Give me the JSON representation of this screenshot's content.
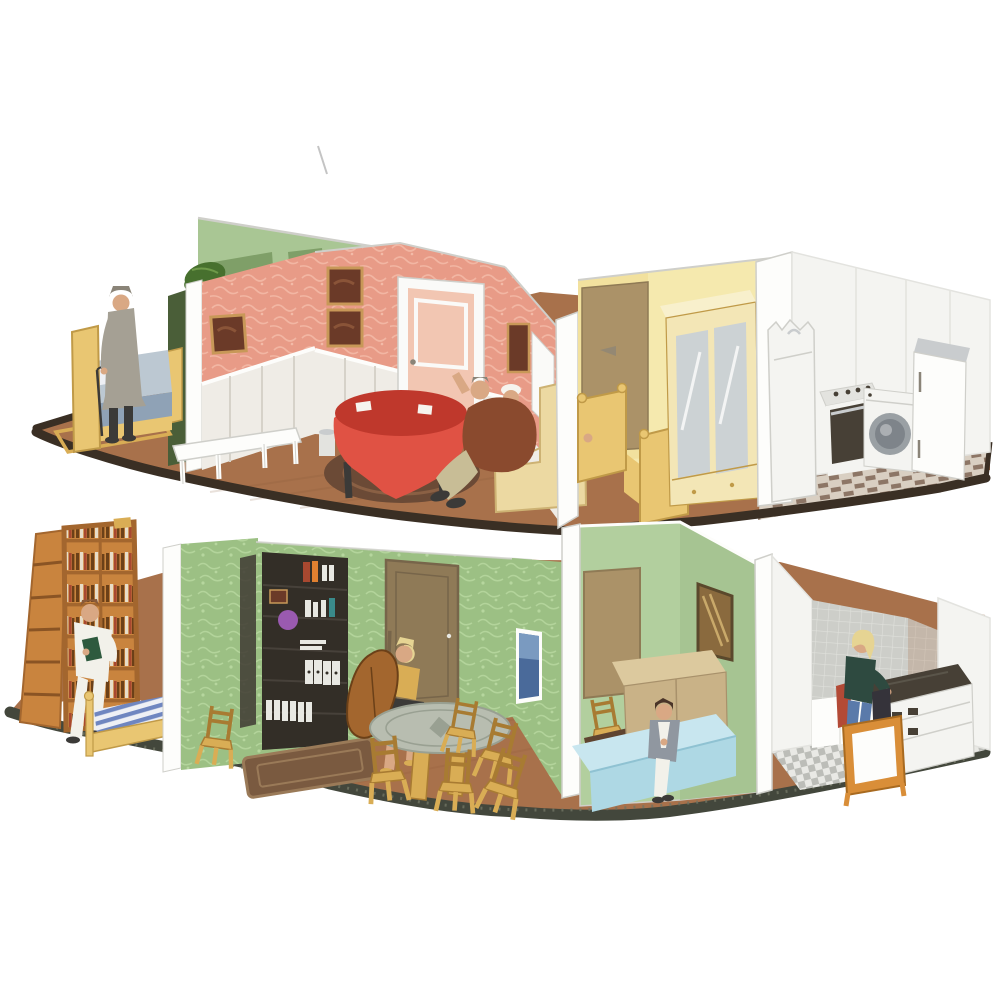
{
  "canvas": {
    "width": 1000,
    "height": 1000,
    "background": "#ffffff"
  },
  "scene": {
    "type": "product-photograph",
    "subject": "two-story miniature dollhouse diorama, open cutaway view, paper/card furniture with painted HO-scale figures on dark base plates",
    "upper_floor": {
      "left_bedroom": [
        "wooden bed with blue-gray mattress",
        "elderly man figure in gray coat and hat with umbrella",
        "yellow-bordered rug"
      ],
      "parlor": [
        "pink floral wallpaper",
        "white wainscoting",
        "two dark framed pictures",
        "pale pink interior door",
        "framed picture on right wall",
        "white side table",
        "gray wastebasket",
        "red round table with white cards",
        "dark oval rug",
        "two seated figures",
        "cream armchair"
      ],
      "bedroom": [
        "pale yellow walls",
        "tan door",
        "yellow bed with sleeping figure's hand visible",
        "cream wardrobe with mirrored doors"
      ],
      "kitchen": [
        "white walls",
        "sink cabinet with faucet",
        "stove with dark oven door",
        "washing machine with round door",
        "white refrigerator",
        "brown basket-weave tile floor"
      ]
    },
    "lower_floor": {
      "library_corner": [
        "tall orange wooden bookshelf full of books",
        "man figure in white pajamas reading a green book",
        "wooden bed with blue striped mattress"
      ],
      "living_room": [
        "green patterned wallpaper",
        "dark bookcase wall print with colored books and purple ball",
        "brown door",
        "blonde woman figure playing a cello",
        "round gray pedestal table",
        "five yellow wooden chairs",
        "brown oriental rug",
        "blue framed picture"
      ],
      "bedroom": [
        "smooth light-green walls",
        "tan door",
        "bronze window",
        "tan wardrobe",
        "light blue bed",
        "seated woman figure in gray jacket",
        "wooden chair and dark desk"
      ],
      "kitchen": [
        "gray tiled walls",
        "white counters",
        "stove with dark cooktop",
        "blonde woman figure at counter in teal top and jeans",
        "orange stool with white panel",
        "gray checkered tile floor"
      ]
    },
    "artifacts": [
      "thin gray scratch line at top center of photo"
    ]
  },
  "palette": {
    "bg": "#ffffff",
    "scratchGray": "#b5b5b5",
    "rimTop": "#3a2f24",
    "rimBottom": "#43473c",
    "rimSpeckle": "#707463",
    "woodFloor": "#a8714b",
    "woodFloorDark": "#875636",
    "tileBrown": "#8d7666",
    "tileCream": "#d9cfc2",
    "greenWallExt": "#a9c694",
    "greenWallExtDark": "#7f9f68",
    "plantGreen": "#47702e",
    "plantGreenLight": "#6f9a4a",
    "darkGreenEdge": "#4a5e38",
    "pinkWall": "#e89b87",
    "pinkWallLight": "#f3bba8",
    "wainscot": "#efece6",
    "wainscotShadow": "#d6d2c9",
    "doorPink": "#f2c6b2",
    "frameWhite": "#fafaf8",
    "whiteBright": "#fdfdfb",
    "grayEdge": "#cfcfca",
    "paintingDark": "#6b3a28",
    "paintingMid": "#8a5438",
    "paintingGold": "#c89858",
    "tableRed": "#e05244",
    "tableRedDark": "#bf382c",
    "cardWhite": "#f6f4ee",
    "rugDark": "#6b4a36",
    "rugRing": "#8a6044",
    "sofaCream": "#ecd9a2",
    "sofaCreamDark": "#cdb273",
    "jacketBrown": "#8a4a2e",
    "pantsBeige": "#c8bd96",
    "flesh": "#d9a884",
    "coatGray": "#a5a094",
    "hatGray": "#8a8478",
    "trouserDark": "#3b3a38",
    "bedYellow": "#e9c672",
    "bedYellowDark": "#c09a48",
    "mattressBlue": "#8fa2b6",
    "mattressBlueLight": "#bcc8d2",
    "yellowWall": "#f5e9ae",
    "yellowWallShade": "#eeda92",
    "doorTan": "#ab9268",
    "doorTanDark": "#8f7a55",
    "wardrobeCream": "#f3e6b6",
    "wardrobeCreamLight": "#f8f0cc",
    "mirrorGray": "#ccd2d4",
    "white": "#f4f4f1",
    "grayPanel": "#e3e3df",
    "ovenDark": "#474036",
    "steel": "#c9ccce",
    "washerRing": "#9aa0a4",
    "washerInner": "#7e848a",
    "bookshelfOrange": "#c9843e",
    "bookshelfDark": "#8a5424",
    "shelfShadow": "#a3662e",
    "bookSpineLight": "#e8ddc8",
    "bookSpineDark": "#6b4018",
    "bookSpineRed": "#a84830",
    "pajamaWhite": "#f2f1ea",
    "hairBrown": "#8a5a38",
    "bookGreen": "#2e5a3e",
    "stripeBlue": "#6f86c0",
    "stripeWhite": "#eef0f5",
    "greenWall": "#9cc084",
    "greenWallPattern": "#b6d69e",
    "greenSmooth": "#b2cf9e",
    "greenSmoothDark": "#a6c492",
    "bookcaseDark": "#332e27",
    "bookcaseLine": "#47413a",
    "purpleBall": "#9a5ab0",
    "binderWhite": "#e8e8e2",
    "tealBook": "#3a8a8a",
    "doorBrown": "#8f7a57",
    "doorBrownDark": "#77654a",
    "tableGray": "#b8bdb0",
    "tableGrayDark": "#99a092",
    "chairYellow": "#d9ad55",
    "chairYellowDark": "#a87b32",
    "rugBrown": "#7a5a40",
    "rugBrownLight": "#9a7a58",
    "bronzeWin": "#8a6a3e",
    "bronzeShine": "#c9a96a",
    "bronzeFrame": "#5a482c",
    "tanWardrobe": "#c9b287",
    "tanWardrobeLight": "#dcc99e",
    "blueBed": "#aed8e4",
    "blueBedLight": "#c8e6ef",
    "grayJacket": "#9097a0",
    "hairDark": "#4a3428",
    "blondHair": "#e6d493",
    "tealTop": "#2e4a40",
    "jeansBlue": "#5a7aaa",
    "darkBin": "#35333a",
    "redItem": "#b34a36",
    "stoolOrange": "#d98e38",
    "stoolOrangeDark": "#a86a20",
    "tileGray": "#bcbdb8",
    "tileGrayLight": "#e9e9e5",
    "tileWallGray": "#cdcec9",
    "tileWallLine": "#e0e1dc",
    "pictureBlue": "#4a6a9a",
    "pictureSky": "#7a9ac0",
    "deskDark": "#5f4430"
  }
}
